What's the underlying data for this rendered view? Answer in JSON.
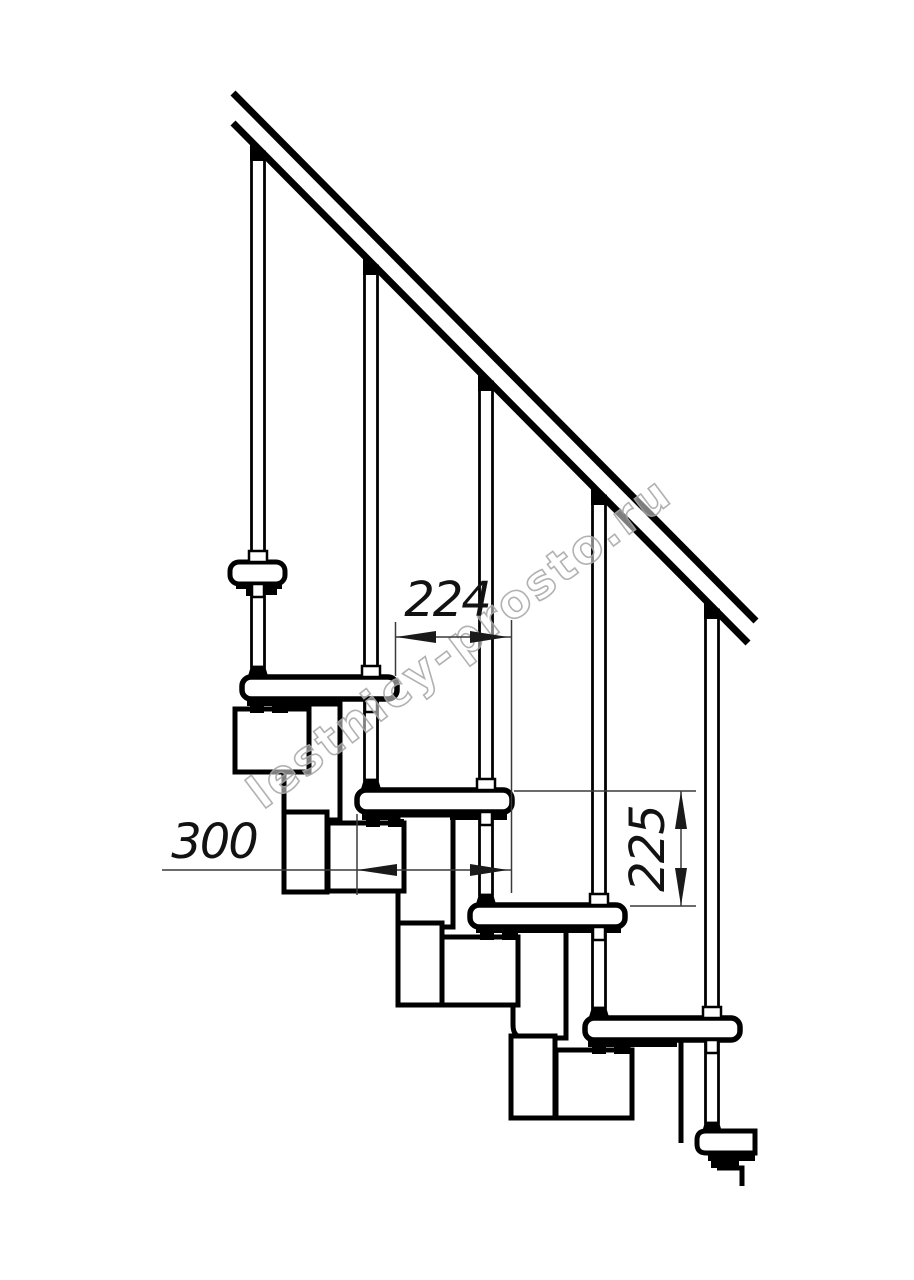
{
  "drawing": {
    "subject": "modular staircase side elevation",
    "watermark": "lestnicy-prosto.ru",
    "dimensions": {
      "step_run": "224",
      "tread_depth": "300",
      "step_rise": "225"
    },
    "counts": {
      "balusters": 5,
      "treads": 6
    },
    "colors": {
      "line": "#000000",
      "dimension_line": "#3a3a3a",
      "dimension_text": "#121212",
      "watermark": "#a9a9a9",
      "background": "#ffffff"
    }
  }
}
